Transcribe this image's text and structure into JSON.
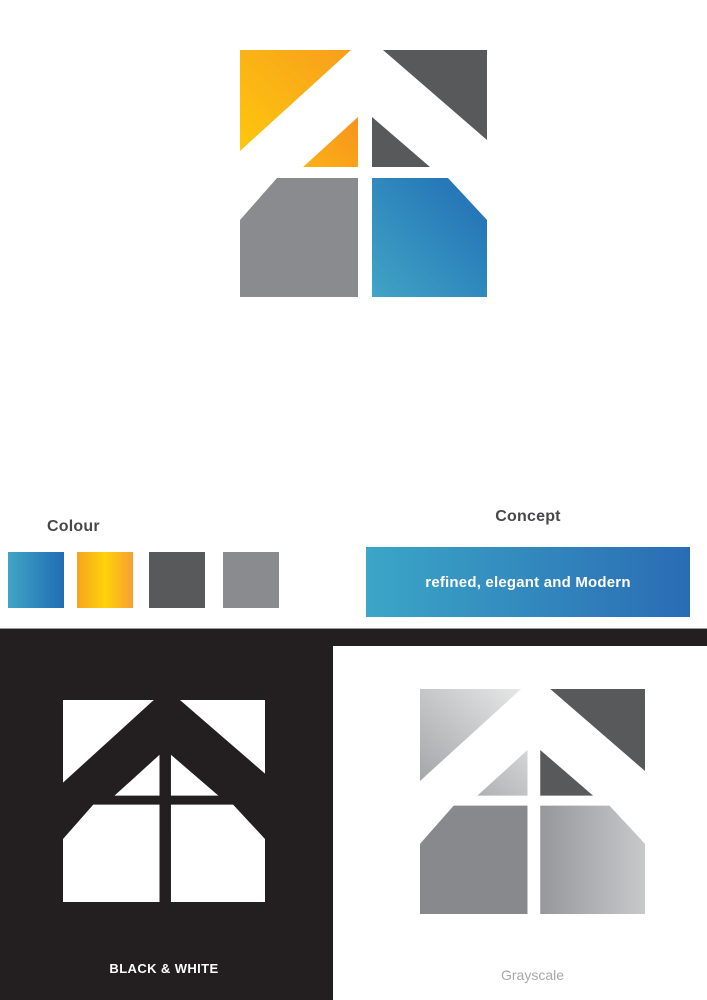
{
  "page": {
    "background": "#FFFFFF"
  },
  "palette": {
    "white": "#FFFFFF",
    "black": "#231F20",
    "dark_gray": "#58595B",
    "medium_gray": "#8A8B8E",
    "yellow_from": "#FDC70E",
    "yellow_to": "#F89E1C",
    "orange_small_from": "#FCB116",
    "orange_small_to": "#F6921E",
    "blue_from": "#41A4C5",
    "blue_to": "#1F6DB4",
    "bar_blue_from": "#3BA6C7",
    "bar_blue_to": "#2A6CB4",
    "swatch_yellow_left": "#F6A41E",
    "swatch_yellow_mid": "#FFD20A",
    "swatch_yellow_right": "#F89F33",
    "gs_large_from": "#A4A6A9",
    "gs_large_to": "#E6E7E7",
    "gs_small_from": "#AFB1B4",
    "gs_small_to": "#D4D5D6",
    "gs_pentagon": "#87898C",
    "gs_right_from": "#95979A",
    "gs_right_to": "#C8C9CB",
    "heading_text": "#48484A",
    "grayscale_text": "#A7A9AC"
  },
  "colour_section": {
    "label": "Colour",
    "swatches": [
      {
        "name": "blue-gradient"
      },
      {
        "name": "yellow-orange-gradient"
      },
      {
        "name": "dark-gray"
      },
      {
        "name": "medium-gray"
      }
    ]
  },
  "concept_section": {
    "label": "Concept",
    "tagline": "refined, elegant and Modern"
  },
  "black_white_section": {
    "label": "BLACK & WHITE"
  },
  "grayscale_section": {
    "label": "Grayscale"
  }
}
